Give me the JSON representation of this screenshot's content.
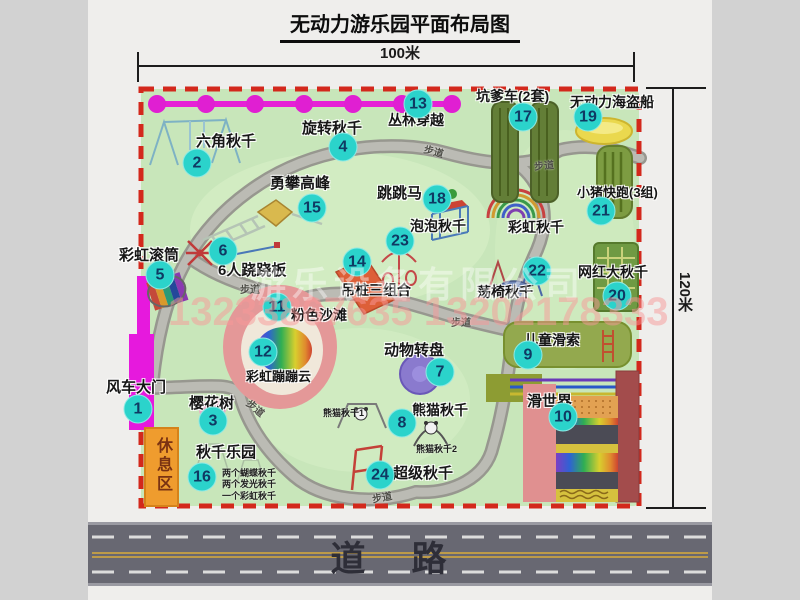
{
  "title": "无动力游乐园平面布局图",
  "dimension_top": "100米",
  "dimension_right": "120米",
  "road_label": "道路",
  "rest_area_label": "休息区",
  "walkway_label": "步道",
  "rainbow_swing_label": "彩虹秋千",
  "watermark": {
    "company": "游乐设备有限公司",
    "phone": "13233867635 13202178333"
  },
  "attractions": [
    {
      "num": "1",
      "label": "风车大门"
    },
    {
      "num": "2",
      "label": "六角秋千"
    },
    {
      "num": "3",
      "label": "樱花树"
    },
    {
      "num": "4",
      "label": "旋转秋千"
    },
    {
      "num": "5",
      "label": "彩虹滚筒"
    },
    {
      "num": "6",
      "label": "6人跷跷板"
    },
    {
      "num": "7",
      "label": "动物转盘"
    },
    {
      "num": "8",
      "label": "熊猫秋千"
    },
    {
      "num": "9",
      "label": "儿童滑索"
    },
    {
      "num": "10",
      "label": "滑世界"
    },
    {
      "num": "11",
      "label": "粉色沙滩"
    },
    {
      "num": "12",
      "label": "彩虹蹦蹦云"
    },
    {
      "num": "13",
      "label": "丛林穿越"
    },
    {
      "num": "14",
      "label": "吊桩三组合"
    },
    {
      "num": "15",
      "label": "勇攀高峰"
    },
    {
      "num": "16",
      "label": "秋千乐园"
    },
    {
      "num": "17",
      "label": "坑爹车(2套)"
    },
    {
      "num": "18",
      "label": "跳跳马"
    },
    {
      "num": "19",
      "label": "无动力海盗船"
    },
    {
      "num": "20",
      "label": "网红大秋千"
    },
    {
      "num": "21",
      "label": "小猪快跑(3组)"
    },
    {
      "num": "22",
      "label": "荡椅秋千"
    },
    {
      "num": "23",
      "label": "泡泡秋千"
    },
    {
      "num": "24",
      "label": "超级秋千"
    }
  ],
  "panda_sub_labels": [
    "熊猫秋千1",
    "熊猫秋千2"
  ],
  "swing_park_notes": [
    "两个蝴蝶秋千",
    "两个发光秋千",
    "一个彩虹秋千"
  ],
  "colors": {
    "map_green": "#c8e6ba",
    "border_red": "#d3281c",
    "badge_cyan": "#2bd3cb",
    "gate_magenta": "#e619dd",
    "road_gray": "#686872",
    "rest_orange": "#ef9c2e"
  }
}
